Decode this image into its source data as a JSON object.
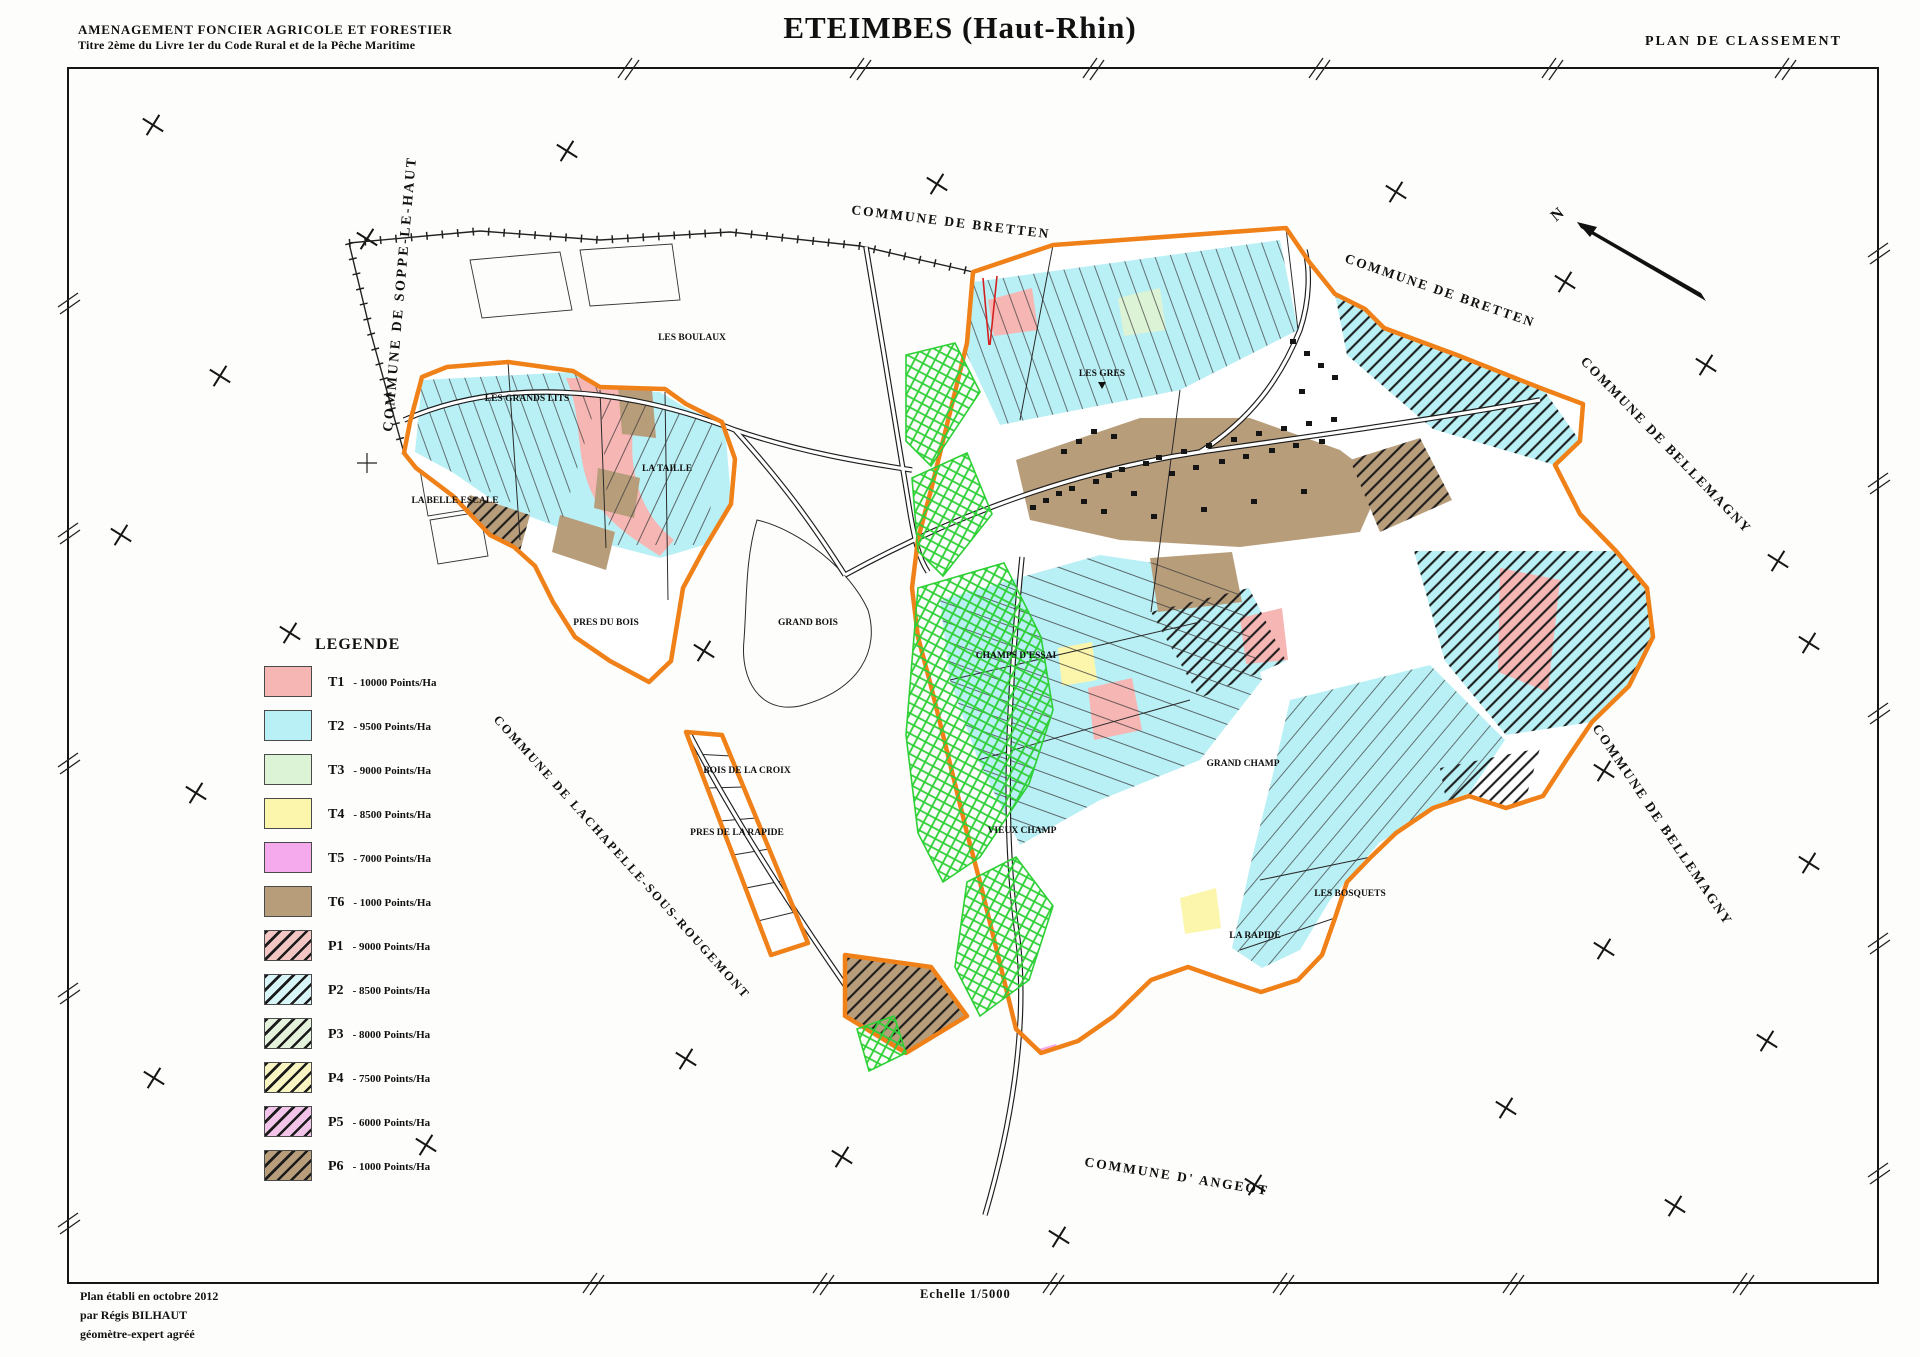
{
  "header": {
    "left_line1": "AMENAGEMENT FONCIER AGRICOLE ET FORESTIER",
    "left_line2": "Titre 2ème du Livre 1er du Code Rural et de la Pêche Maritime",
    "title": "ETEIMBES (Haut-Rhin)",
    "right_label": "PLAN DE CLASSEMENT"
  },
  "legend": {
    "title": "LEGENDE",
    "items": [
      {
        "code": "T1",
        "points": "-  10000 Points/Ha",
        "color": "#f6b6b4",
        "hatched": false
      },
      {
        "code": "T2",
        "points": "-  9500 Points/Ha",
        "color": "#b9f0f5",
        "hatched": false
      },
      {
        "code": "T3",
        "points": "-  9000 Points/Ha",
        "color": "#ddf3d6",
        "hatched": false
      },
      {
        "code": "T4",
        "points": "-  8500 Points/Ha",
        "color": "#fbf6ab",
        "hatched": false
      },
      {
        "code": "T5",
        "points": "-  7000 Points/Ha",
        "color": "#f5aaee",
        "hatched": false
      },
      {
        "code": "T6",
        "points": "-  1000 Points/Ha",
        "color": "#b89d7b",
        "hatched": false
      },
      {
        "code": "P1",
        "points": "-  9000 Points/Ha",
        "color": "#f3c6c4",
        "hatched": true
      },
      {
        "code": "P2",
        "points": "-  8500 Points/Ha",
        "color": "#d8f6f8",
        "hatched": true
      },
      {
        "code": "P3",
        "points": "-  8000 Points/Ha",
        "color": "#e6f3dc",
        "hatched": true
      },
      {
        "code": "P4",
        "points": "-  7500 Points/Ha",
        "color": "#f9f5c2",
        "hatched": true
      },
      {
        "code": "P5",
        "points": "-  6000 Points/Ha",
        "color": "#f2c4ea",
        "hatched": true
      },
      {
        "code": "P6",
        "points": "-  1000 Points/Ha",
        "color": "#b89d7b",
        "hatched": true
      }
    ]
  },
  "footer": {
    "line1": "Plan établi en octobre 2012",
    "line2": "par Régis BILHAUT",
    "line3": "géomètre-expert agréé",
    "scale_label": "Echelle 1/5000"
  },
  "map": {
    "north_label": "N",
    "communes": [
      "COMMUNE DE SOPPE-LE-HAUT",
      "COMMUNE DE BRETTEN",
      "COMMUNE DE BRETTEN",
      "COMMUNE DE BELLEMAGNY",
      "COMMUNE DE BELLEMAGNY",
      "COMMUNE DE LACHAPELLE-SOUS-ROUGEMONT",
      "COMMUNE D' ANGEOT"
    ],
    "lieu_dits": [
      "LES BOULAUX",
      "LES GRANDS LITS",
      "LA TAILLE",
      "LA BELLE ESCALE",
      "PRES DU BOIS",
      "GRAND BOIS",
      "BOIS DE LA CROIX",
      "PRES DE LA RAPIDE",
      "LES GRES",
      "CHAMPS D'ESSAI",
      "GRAND CHAMP",
      "VIEUX CHAMP",
      "LA RAPIDE",
      "LES BOSQUETS"
    ],
    "colors": {
      "boundary_orange": "#f08018",
      "highlight_green": "#2ed036",
      "red_mark": "#d42020"
    }
  }
}
